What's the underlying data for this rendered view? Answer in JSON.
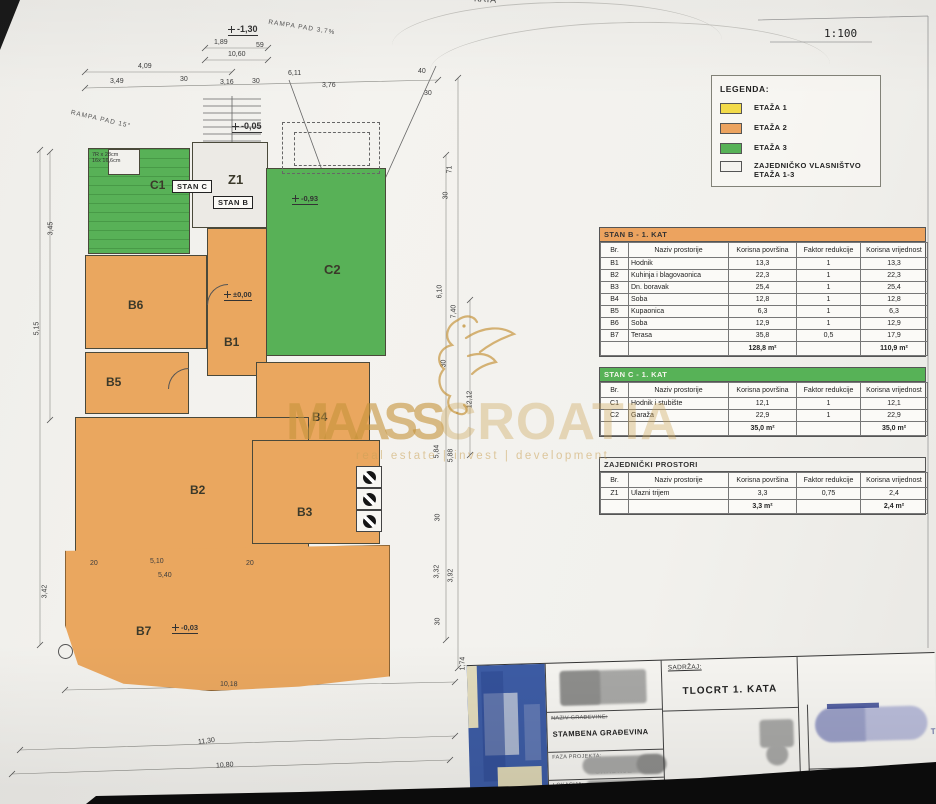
{
  "meta": {
    "scale": "1:100",
    "top_fragment": "KATA",
    "right_edge_fragment": "T"
  },
  "legend": {
    "title": "LEGENDA:",
    "items": [
      {
        "label": "ETAŽA 1",
        "label2": "",
        "color": "#f2da49"
      },
      {
        "label": "ETAŽA 2",
        "label2": "",
        "color": "#eca35f"
      },
      {
        "label": "ETAŽA 3",
        "label2": "",
        "color": "#57b257"
      },
      {
        "label": "ZAJEDNIČKO VLASNIŠTVO",
        "label2": "ETAŽA 1-3",
        "color": "#f4f3ef"
      }
    ]
  },
  "tables": [
    {
      "title": "STAN B - 1. KAT",
      "header_color": "#eca35f",
      "title_light_text": false,
      "columns": [
        "Br.",
        "Naziv prostorije",
        "Korisna površina",
        "Faktor redukcije",
        "Korisna vrijednost"
      ],
      "rows": [
        [
          "B1",
          "Hodnik",
          "13,3",
          "1",
          "13,3"
        ],
        [
          "B2",
          "Kuhinja i blagovaonica",
          "22,3",
          "1",
          "22,3"
        ],
        [
          "B3",
          "Dn. boravak",
          "25,4",
          "1",
          "25,4"
        ],
        [
          "B4",
          "Soba",
          "12,8",
          "1",
          "12,8"
        ],
        [
          "B5",
          "Kupaonica",
          "6,3",
          "1",
          "6,3"
        ],
        [
          "B6",
          "Soba",
          "12,9",
          "1",
          "12,9"
        ],
        [
          "B7",
          "Terasa",
          "35,8",
          "0,5",
          "17,9"
        ]
      ],
      "total_povrsina": "128,8 m²",
      "total_vrijednost": "110,9 m²"
    },
    {
      "title": "STAN C - 1. KAT",
      "header_color": "#57b257",
      "title_light_text": true,
      "columns": [
        "Br.",
        "Naziv prostorije",
        "Korisna površina",
        "Faktor redukcije",
        "Korisna vrijednost"
      ],
      "rows": [
        [
          "C1",
          "Hodnik i stubište",
          "12,1",
          "1",
          "12,1"
        ],
        [
          "C2",
          "Garaža",
          "22,9",
          "1",
          "22,9"
        ]
      ],
      "total_povrsina": "35,0 m²",
      "total_vrijednost": "35,0 m²"
    },
    {
      "title": "ZAJEDNIČKI PROSTORI",
      "header_color": "#f1f0ec",
      "title_light_text": false,
      "columns": [
        "Br.",
        "Naziv prostorije",
        "Korisna površina",
        "Faktor redukcije",
        "Korisna vrijednost"
      ],
      "rows": [
        [
          "Z1",
          "Ulazni trijem",
          "3,3",
          "0,75",
          "2,4"
        ]
      ],
      "total_povrsina": "3,3 m²",
      "total_vrijednost": "2,4 m²"
    }
  ],
  "plan": {
    "rooms": {
      "c1": "C1",
      "c2": "C2",
      "b1": "B1",
      "b2": "B2",
      "b3": "B3",
      "b4": "B4",
      "b5": "B5",
      "b6": "B6",
      "b7": "B7",
      "z1": "Z1"
    },
    "unit_tags": {
      "stan_c": "STAN C",
      "stan_b": "STAN B"
    },
    "elevations": {
      "e_130": "-1,30",
      "e_005": "-0,05",
      "e_093": "-0,93",
      "e_000": "±0,00",
      "e_003": "-0,03"
    },
    "ramps": {
      "r1": "RAMPA PAD 3,7%",
      "r2": "RAMPA PAD 15°"
    },
    "stair_note1": "7R x 28cm",
    "stair_note2": "16x 16,6cm",
    "dims": [
      "1,89",
      "59",
      "10,60",
      "4,09",
      "3,49",
      "30",
      "3,16",
      "30",
      "6,11",
      "3,76",
      "40",
      "30",
      "3,45",
      "5,15",
      "3,42",
      "71",
      "30",
      "6,10",
      "7,40",
      "30",
      "12,12",
      "5,84",
      "5,88",
      "30",
      "3,32",
      "3,92",
      "30",
      "1,74",
      "20",
      "5,10",
      "20",
      "5,40",
      "10,18",
      "11,30",
      "10,80"
    ]
  },
  "watermark": {
    "brand_primary": "MAASS",
    "brand_secondary": "CROATIA",
    "tagline": "real estate | invest | development"
  },
  "titleblock": {
    "sadrzaj_label": "SADRŽAJ:",
    "content_title": "TLOCRT 1. KATA",
    "naziv_label": "NAZIV GRAĐEVINE:",
    "building_name": "STAMBENA GRAĐEVINA",
    "faza_label": "FAZA PROJEKTA:",
    "faza_partial": "GRADNJE",
    "lokacija_label": "LOKACIJA:"
  }
}
